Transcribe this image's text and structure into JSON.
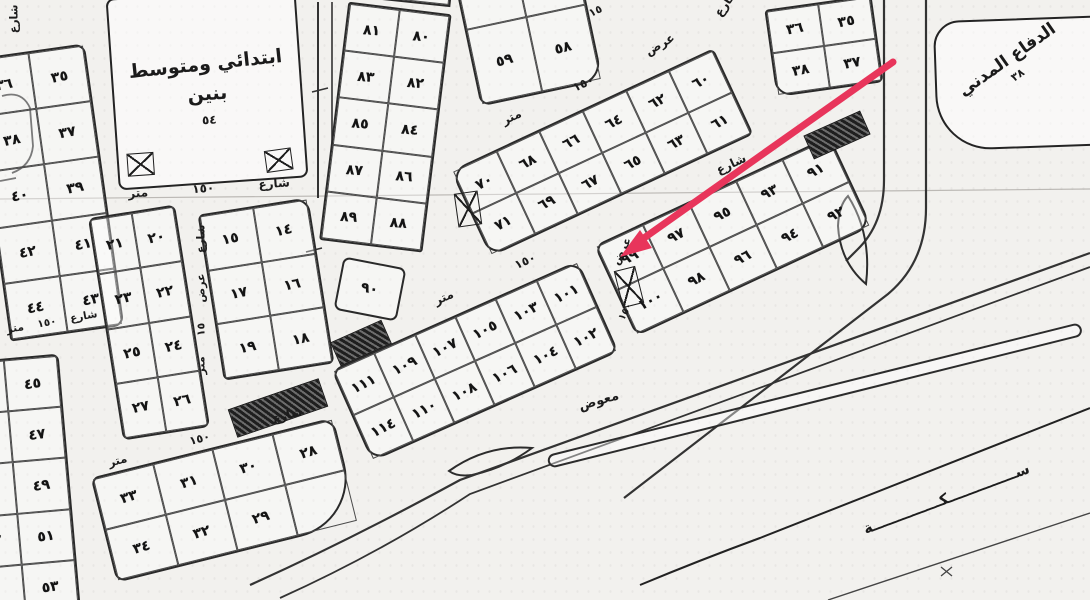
{
  "map": {
    "words": {
      "street": "شارع",
      "width": "عرض",
      "meter": "متر",
      "n150": "١٥٠",
      "n15": "١٥"
    },
    "school": {
      "line1": "ابتدائي ومتوسط",
      "line2": "بنين",
      "number": "٥٤"
    },
    "civil_defense": {
      "title": "الدفاع المدني",
      "number": "٣٨"
    },
    "annotations": {
      "road_name": "معوض",
      "railway": "ســــــــــــــكــــــــــــــة",
      "tick": "×"
    },
    "plot_90": "٩٠",
    "arrow_color": "#e8355b",
    "blocks": {
      "block_35_44": [
        [
          "٣٦",
          "٣٥"
        ],
        [
          "٣٨",
          "٣٧"
        ],
        [
          "٤٠",
          "٣٩"
        ],
        [
          "٤٢",
          "٤١"
        ],
        [
          "٤٤",
          "٤٣"
        ]
      ],
      "block_45_53": [
        [
          "٤٦",
          "٤٥"
        ],
        [
          "٤٨",
          "٤٧"
        ],
        [
          "٥٠",
          "٤٩"
        ],
        [
          "٥٢",
          "٥١"
        ],
        [
          "",
          "٥٣"
        ]
      ],
      "block_20_27": [
        [
          "٢١",
          "٢٠"
        ],
        [
          "٢٣",
          "٢٢"
        ],
        [
          "٢٥",
          "٢٤"
        ],
        [
          "٢٧",
          "٢٦"
        ]
      ],
      "block_14_19": [
        [
          "١٥",
          "١٤"
        ],
        [
          "١٧",
          "١٦"
        ],
        [
          "١٩",
          "١٨"
        ]
      ],
      "block_56_59": [
        [
          "",
          ""
        ],
        [
          "٥٩",
          "٥٨"
        ]
      ],
      "block_35_38_east": [
        [
          "٣٦",
          "٣٥"
        ],
        [
          "٣٨",
          "٣٧"
        ]
      ],
      "strip_80_89": [
        [
          "٨١",
          "٨٠"
        ],
        [
          "٨٣",
          "٨٢"
        ],
        [
          "٨٥",
          "٨٤"
        ],
        [
          "٨٧",
          "٨٦"
        ],
        [
          "٨٩",
          "٨٨"
        ]
      ],
      "strip_top_sliver": [
        [
          "",
          ""
        ]
      ],
      "strip_60_71": [
        [
          "٧٠",
          "٦٨",
          "٦٦",
          "٦٤",
          "٦٢",
          "٦٠"
        ],
        [
          "٧١",
          "٦٩",
          "٦٧",
          "٦٥",
          "٦٣",
          "٦١"
        ]
      ],
      "strip_91_100": [
        [
          "٩٩",
          "٩٧",
          "٩٥",
          "٩٣",
          "٩١"
        ],
        [
          "١٠٠",
          "٩٨",
          "٩٦",
          "٩٤",
          "٩٢"
        ]
      ],
      "strip_101_114": [
        [
          "١١١",
          "١٠٩",
          "١٠٧",
          "١٠٥",
          "١٠٣",
          "١٠١"
        ],
        [
          "١١٤",
          "١١٠",
          "١٠٨",
          "١٠٦",
          "١٠٤",
          "١٠٢"
        ]
      ],
      "strip_28_34": [
        [
          "٣٣",
          "٣١",
          "٣٠",
          "٢٨"
        ],
        [
          "٣٤",
          "٣٢",
          "٢٩",
          ""
        ]
      ]
    }
  }
}
